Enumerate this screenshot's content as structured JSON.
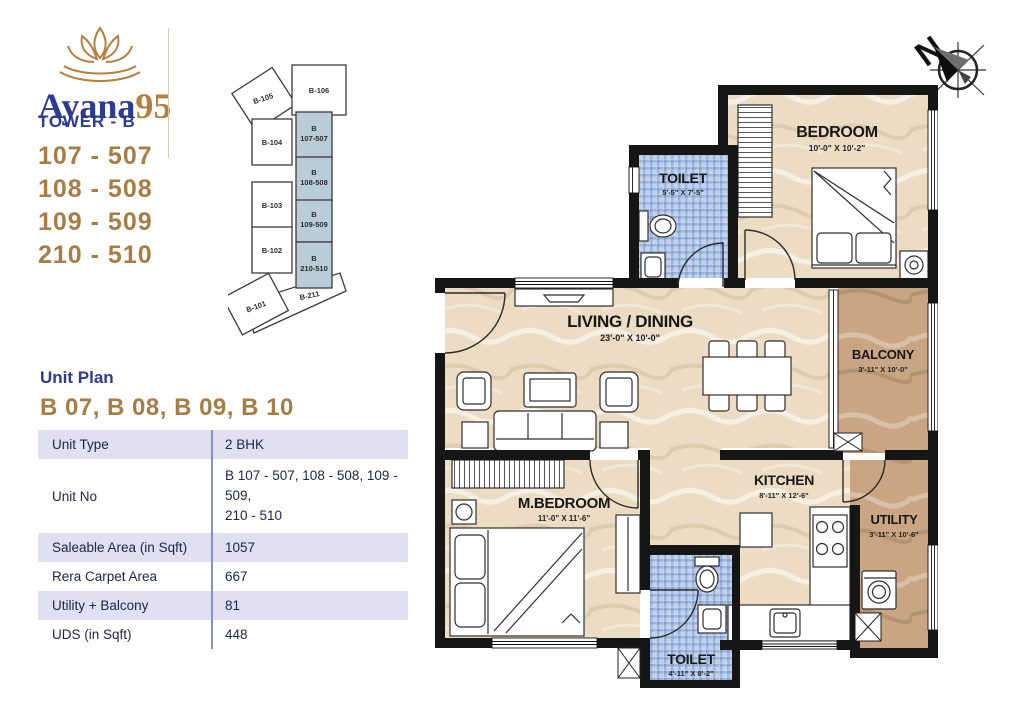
{
  "brand": {
    "name": "Ayana",
    "suffix": "95",
    "blue": "#2b3a92",
    "tan": "#b5803f"
  },
  "compass": {
    "label": "N"
  },
  "tower": {
    "title": "TOWER - B",
    "units": [
      "107 - 507",
      "108 - 508",
      "109 - 509",
      "210 - 510"
    ]
  },
  "key_plan": {
    "highlight_color": "#b8cdd7",
    "b105": "B-105",
    "b106": "B-106",
    "b104": "B-104",
    "b103": "B-103",
    "b102": "B-102",
    "b211": "B-211",
    "b101": "B-101",
    "h1a": "B",
    "h1b": "107-507",
    "h2a": "B",
    "h2b": "108-508",
    "h3a": "B",
    "h3b": "109-509",
    "h4a": "B",
    "h4b": "210-510"
  },
  "unit_plan": {
    "heading": "Unit Plan",
    "subheading": "B 07, B 08, B 09, B 10"
  },
  "table": {
    "rows": [
      {
        "label": "Unit Type",
        "value": "2 BHK"
      },
      {
        "label": "Unit No",
        "value": "B 107 - 507, 108 - 508, 109 - 509,",
        "value2": "210 - 510"
      },
      {
        "label": "Saleable Area (in Sqft)",
        "value": "1057"
      },
      {
        "label": "Rera Carpet Area",
        "value": "667"
      },
      {
        "label": "Utility + Balcony",
        "value": "81"
      },
      {
        "label": "UDS (in Sqft)",
        "value": "448"
      }
    ]
  },
  "rooms": {
    "bedroom": {
      "name": "BEDROOM",
      "dims": "10'-0\" X 10'-2\""
    },
    "toilet1": {
      "name": "TOILET",
      "dims": "5'-5\" X 7'-5\""
    },
    "living": {
      "name": "LIVING / DINING",
      "dims": "23'-0\" X 10'-0\""
    },
    "balcony": {
      "name": "BALCONY",
      "dims": "3'-11\" X 10'-0\""
    },
    "mbedroom": {
      "name": "M.BEDROOM",
      "dims": "11'-0\" X 11'-6\""
    },
    "kitchen": {
      "name": "KITCHEN",
      "dims": "8'-11\" X 12'-6\""
    },
    "utility": {
      "name": "UTILITY",
      "dims": "3'-11\" X 10'-6\""
    },
    "toilet2": {
      "name": "TOILET",
      "dims": "4'-11\" X 8'-2\""
    }
  }
}
